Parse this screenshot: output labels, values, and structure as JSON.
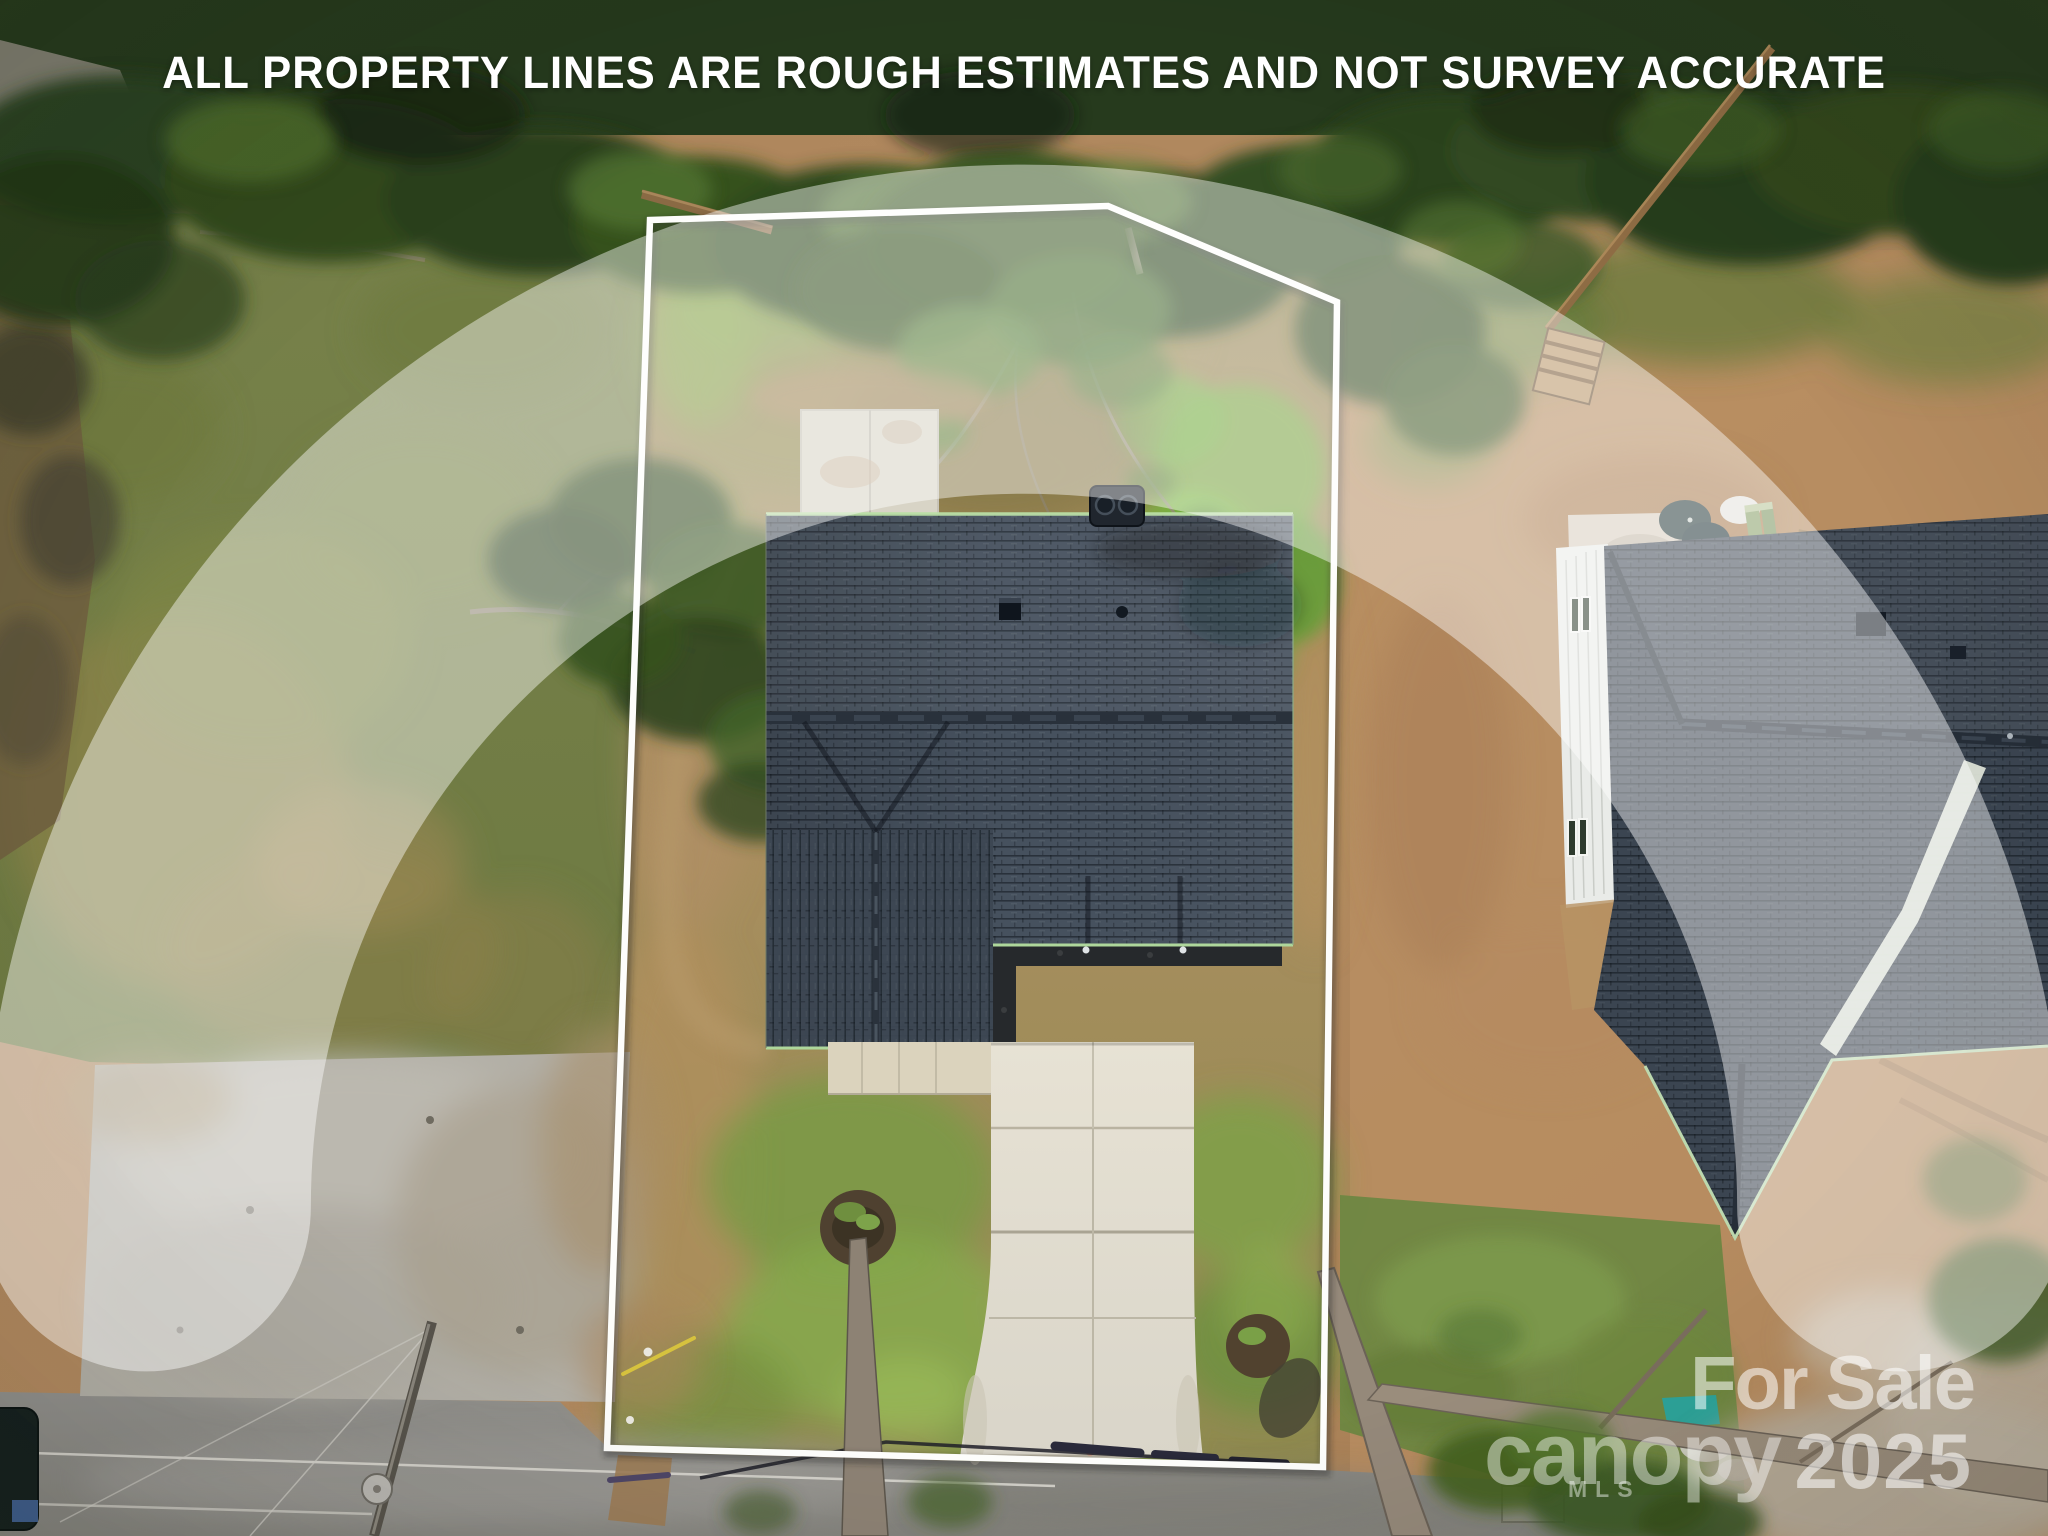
{
  "overlay": {
    "disclaimer": "ALL PROPERTY LINES ARE ROUGH ESTIMATES AND NOT SURVEY ACCURATE"
  },
  "watermark": {
    "sale_text": "For Sale",
    "year": "2025",
    "brand": "canopy",
    "brand_sub": "MLS"
  },
  "scene": {
    "description": "Aerial drone photo of a newly built home on a cleared lot with a white property-boundary overlay, concrete driveway to a road below, gravel pad and field at left, wooded tree line at top, and a neighboring new-construction house at right",
    "colors": {
      "boundary_line": "#ffffff",
      "subject_roof": "#46515e",
      "neighbor_roof": "#3a434e",
      "lot_grass": "#76843f",
      "dirt": "#b08a5c",
      "road_asphalt": "#8f8e8a",
      "concrete": "#ded9cb",
      "tree_canopy": "#2c3e21",
      "watermark_white": "rgba(255,255,255,0.5)"
    }
  }
}
